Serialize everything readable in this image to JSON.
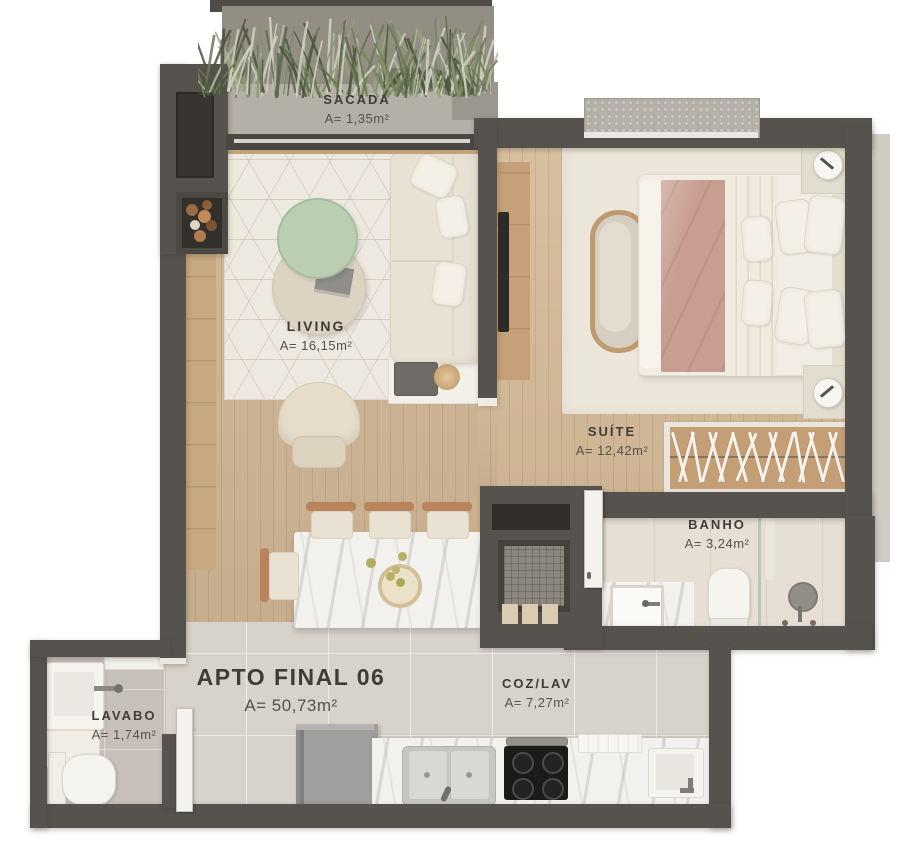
{
  "title": {
    "name": "APTO FINAL 06",
    "area": "A= 50,73m²"
  },
  "rooms": {
    "sacada": {
      "label": "SACADA",
      "area": "A= 1,35m²"
    },
    "living": {
      "label": "LIVING",
      "area": "A= 16,15m²"
    },
    "suite": {
      "label": "SUÍTE",
      "area": "A= 12,42m²"
    },
    "banho": {
      "label": "BANHO",
      "area": "A= 3,24m²"
    },
    "lavabo": {
      "label": "LAVABO",
      "area": "A= 1,74m²"
    },
    "coz_lav": {
      "label": "COZ/LAV",
      "area": "A= 7,27m²"
    }
  },
  "colors": {
    "wall": "#56524d",
    "wood": "#cdb493",
    "tile": "#d7d2ca",
    "tile-lavabo": "#c7c0b8",
    "tile-banho": "#e7dfd3",
    "marble": "#f3f1ee",
    "rug": "#eee9e0",
    "concrete": "#b4afa7",
    "ink": "#3c3935",
    "pink": "#c79e90",
    "green": "#bacfb2",
    "cream": "#e9e2d4"
  }
}
